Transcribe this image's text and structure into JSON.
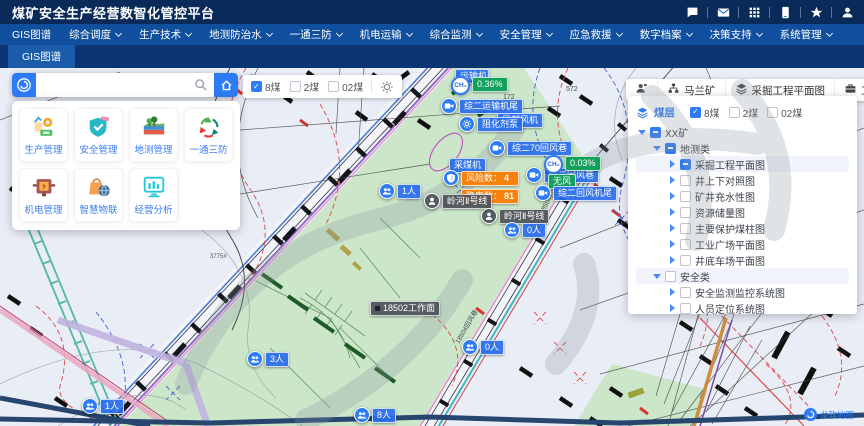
{
  "header": {
    "title": "煤矿安全生产经营数智化管控平台",
    "icons": [
      "chat-icon",
      "mail-icon",
      "apps-icon",
      "mobile-icon",
      "star-icon",
      "user-icon"
    ]
  },
  "nav": {
    "items": [
      {
        "label": "GIS图谱",
        "caret": false
      },
      {
        "label": "综合调度",
        "caret": true
      },
      {
        "label": "生产技术",
        "caret": true
      },
      {
        "label": "地测防治水",
        "caret": true
      },
      {
        "label": "一通三防",
        "caret": true
      },
      {
        "label": "机电运输",
        "caret": true
      },
      {
        "label": "综合监测",
        "caret": true
      },
      {
        "label": "安全管理",
        "caret": true
      },
      {
        "label": "应急救援",
        "caret": true
      },
      {
        "label": "数字档案",
        "caret": true
      },
      {
        "label": "决策支持",
        "caret": true
      },
      {
        "label": "系统管理",
        "caret": true
      }
    ]
  },
  "tabs": {
    "active": "GIS图谱"
  },
  "search": {
    "placeholder": ""
  },
  "launcher": {
    "cards": [
      {
        "label": "生产管理",
        "icon": "production-icon"
      },
      {
        "label": "安全管理",
        "icon": "safety-icon"
      },
      {
        "label": "地测管理",
        "icon": "geology-icon"
      },
      {
        "label": "一通三防",
        "icon": "ventilation-icon"
      },
      {
        "label": "机电管理",
        "icon": "mechatronics-icon"
      },
      {
        "label": "智慧物联",
        "icon": "iot-icon"
      },
      {
        "label": "经营分析",
        "icon": "analysis-icon"
      }
    ]
  },
  "coal_seams": [
    {
      "label": "8煤",
      "checked": true
    },
    {
      "label": "2煤",
      "checked": false
    },
    {
      "label": "02煤",
      "checked": false
    }
  ],
  "right_bar": {
    "buttons": [
      {
        "name": "org-button",
        "icon": "org-icon",
        "label": ""
      },
      {
        "name": "mine-selector",
        "icon": "mine-icon",
        "label": "马兰矿"
      },
      {
        "name": "plan-view-button",
        "icon": "layers-icon",
        "label": "采掘工程平面图"
      },
      {
        "name": "tools-button",
        "icon": "toolbox-icon",
        "label": "工具"
      }
    ]
  },
  "layer_panel": {
    "title": "煤层",
    "tree": [
      {
        "depth": 0,
        "caret": "down",
        "box": "ind",
        "label": "XX矿",
        "hl": false
      },
      {
        "depth": 1,
        "caret": "down",
        "box": "ind",
        "label": "地测类",
        "hl": false
      },
      {
        "depth": 2,
        "caret": "right",
        "box": "ind",
        "label": "采掘工程平面图",
        "hl": true
      },
      {
        "depth": 2,
        "caret": "right",
        "box": "off",
        "label": "井上下对照图",
        "hl": false
      },
      {
        "depth": 2,
        "caret": "right",
        "box": "off",
        "label": "矿井充水性图",
        "hl": false
      },
      {
        "depth": 2,
        "caret": "right",
        "box": "off",
        "label": "资源储量图",
        "hl": false
      },
      {
        "depth": 2,
        "caret": "right",
        "box": "off",
        "label": "主要保护煤柱图",
        "hl": false
      },
      {
        "depth": 2,
        "caret": "right",
        "box": "off",
        "label": "工业广场平面图",
        "hl": false
      },
      {
        "depth": 2,
        "caret": "right",
        "box": "off",
        "label": "井底车场平面图",
        "hl": false
      },
      {
        "depth": 1,
        "caret": "down",
        "box": "off",
        "label": "安全类",
        "hl": true
      },
      {
        "depth": 2,
        "caret": "right",
        "box": "off",
        "label": "安全监测监控系统图",
        "hl": false
      },
      {
        "depth": 2,
        "caret": "right",
        "box": "off",
        "label": "人员定位系统图",
        "hl": false
      }
    ]
  },
  "map": {
    "gas_label": "CH₄",
    "logo": "龙软地图",
    "markers": [
      {
        "id": "equip-tag-head",
        "type": "tag",
        "x": 455,
        "y": 0,
        "text": "运输机头",
        "color": "blue",
        "w": 34
      },
      {
        "id": "ch4-sensor-1",
        "type": "ch4",
        "x": 451,
        "y": 8,
        "value": "0.36%"
      },
      {
        "id": "camera-conveyor-tail",
        "type": "camera",
        "x": 441,
        "y": 30,
        "label": "综二运输机尾"
      },
      {
        "id": "equip-tag-fan",
        "type": "tag",
        "x": 497,
        "y": 44,
        "text": "局部风机",
        "color": "blue"
      },
      {
        "id": "gear-inhibitor-pump",
        "type": "gear",
        "x": 459,
        "y": 48,
        "label": "阻化剂泵"
      },
      {
        "id": "camera-70-return",
        "type": "camera",
        "x": 489,
        "y": 72,
        "label": "综二70回风巷"
      },
      {
        "id": "camera-return",
        "type": "camera",
        "x": 526,
        "y": 99,
        "label": "综二回风巷"
      },
      {
        "id": "ch4-sensor-2",
        "type": "ch4",
        "x": 544,
        "y": 87,
        "value": "0.03%"
      },
      {
        "id": "no-wind-tag",
        "type": "tag",
        "x": 548,
        "y": 105,
        "text": "无风",
        "color": "green"
      },
      {
        "id": "camera-return-tail",
        "type": "camera",
        "x": 535,
        "y": 117,
        "label": "综二回风机尾"
      },
      {
        "id": "shearer-tag",
        "type": "tag",
        "x": 449,
        "y": 89,
        "text": "采煤机",
        "color": "blue"
      },
      {
        "id": "risk-marker",
        "type": "shield",
        "x": 443,
        "y": 102,
        "rows": [
          {
            "k": "风险数：",
            "v": "4"
          },
          {
            "k": "隐患数：",
            "v": "81"
          }
        ]
      },
      {
        "id": "person-line-1",
        "type": "person",
        "x": 424,
        "y": 125,
        "label": "岭河Ⅱ号线"
      },
      {
        "id": "person-line-2",
        "type": "person",
        "x": 481,
        "y": 140,
        "label": "岭河Ⅱ号线"
      },
      {
        "id": "people-count-0a",
        "type": "people",
        "x": 504,
        "y": 154,
        "label": "0人"
      },
      {
        "id": "people-count-1a",
        "type": "people",
        "x": 379,
        "y": 115,
        "label": "1人"
      },
      {
        "id": "workface-tag",
        "type": "tag",
        "x": 370,
        "y": 232,
        "text": "18502工作面",
        "color": "gray",
        "icon": true
      },
      {
        "id": "people-count-3",
        "type": "people",
        "x": 247,
        "y": 283,
        "label": "3人"
      },
      {
        "id": "people-count-0b",
        "type": "people",
        "x": 462,
        "y": 271,
        "label": "0人"
      },
      {
        "id": "people-count-8",
        "type": "people",
        "x": 354,
        "y": 339,
        "label": "8人"
      },
      {
        "id": "people-count-1b",
        "type": "people",
        "x": 82,
        "y": 330,
        "label": "1人"
      }
    ],
    "texts": [
      {
        "t": "172",
        "x": 503,
        "y": 26,
        "s": 7,
        "r": 0,
        "c": "#4a4a55"
      },
      {
        "t": "572",
        "x": 566,
        "y": 18,
        "s": 7,
        "r": 0,
        "c": "#4a4a55"
      },
      {
        "t": "3775#",
        "x": 210,
        "y": 186,
        "s": 6,
        "r": 0,
        "c": "#555555"
      },
      {
        "t": "18504胶带巷",
        "x": 536,
        "y": 142,
        "s": 6.5,
        "r": -60,
        "c": "#444455"
      },
      {
        "t": "18504回风巷",
        "x": 452,
        "y": 272,
        "s": 6.5,
        "r": -60,
        "c": "#444455"
      }
    ]
  }
}
